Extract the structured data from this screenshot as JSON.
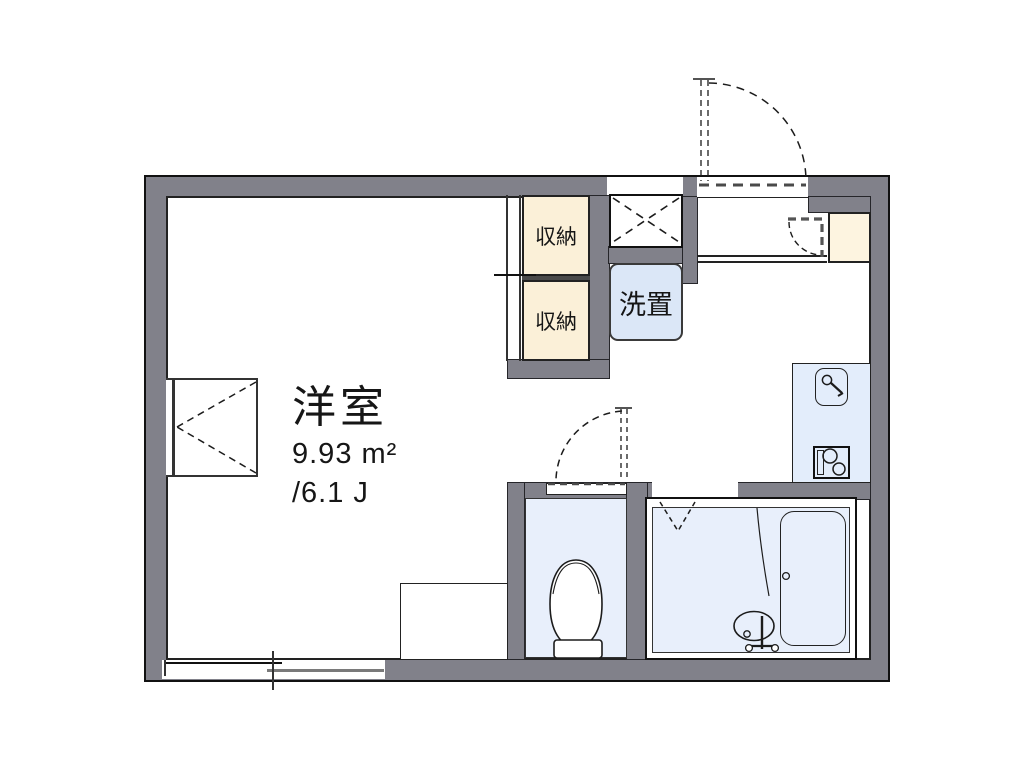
{
  "plan": {
    "type": "apartment-floor-plan",
    "rooms": {
      "main_room": {
        "name": "洋室",
        "area_sqm": "9.93 m²",
        "area_tatami": "/6.1 J"
      },
      "closet_upper": {
        "name": "収納"
      },
      "closet_lower": {
        "name": "収納"
      },
      "washer_space": {
        "name": "洗置"
      }
    },
    "fixtures": [
      "entrance-door-swing",
      "meter-box-cross",
      "shoe-cabinet",
      "shoe-cabinet-door-swing",
      "kitchen-sink",
      "sink-faucet",
      "gas-stove",
      "toilet",
      "toilet-door-swing",
      "bathtub",
      "bathtub-drain",
      "washbasin",
      "bath-folding-door",
      "casement-window-west",
      "sliding-window-south",
      "closet-sliding-doors",
      "step-edge"
    ],
    "colors": {
      "wall": "#81818a",
      "outline": "#1a1a1a",
      "closet": "#fbf0d8",
      "shoebox": "#fdf4e0",
      "washer": "#dbe7f7",
      "wetroom": "#e8effb",
      "kitchen": "#e3edfb",
      "background": "#ffffff"
    }
  }
}
